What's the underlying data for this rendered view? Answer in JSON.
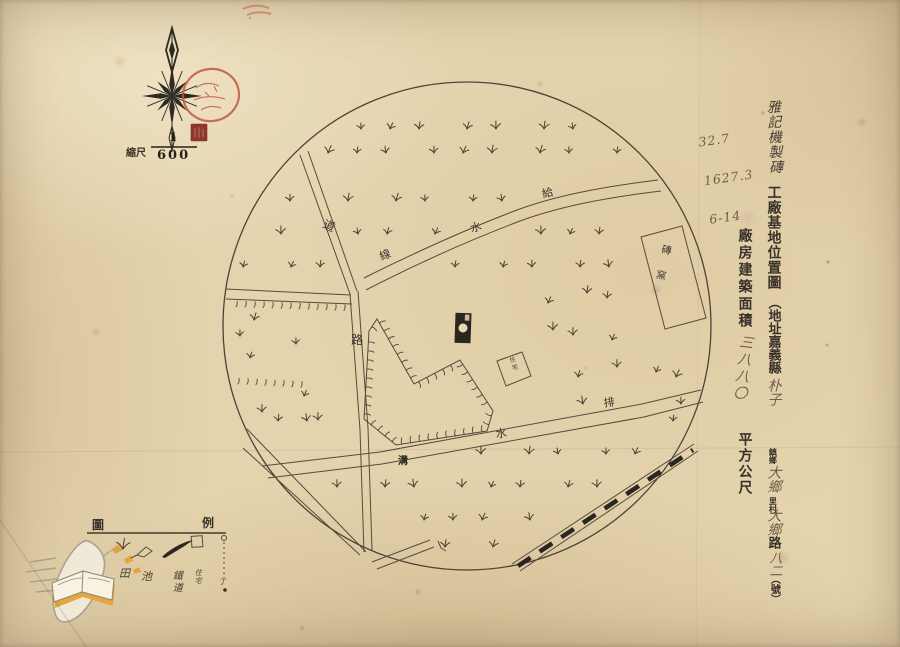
{
  "scale": {
    "label": "縮尺",
    "numerator": "1",
    "denominator": "600"
  },
  "annotations": {
    "note1": "32.7",
    "note2": "1627.3",
    "note3": "6-14"
  },
  "title_block": {
    "company_handwritten": "雅記機製磚",
    "title_typed": "工廠基地位置圖",
    "address_prefix": "（地址嘉義縣",
    "address_town_hand": "朴子",
    "address_unit_town": "鎮鄉",
    "address_li_hand": "大鄉",
    "address_unit_li": "里村",
    "address_road_hand": "大鄉",
    "address_road_typed": "路",
    "address_no_hand": "八二",
    "address_no_typed": "（號）",
    "area_label": "廠房建築面積",
    "area_value_hand": "三八八〇",
    "area_unit": "平方公尺"
  },
  "map_labels": {
    "road_upper": "道",
    "road_main": "路",
    "waterline": [
      "給",
      "水",
      "線"
    ],
    "drain": [
      "排",
      "水",
      "溝"
    ],
    "kiln": "磚窯",
    "house": "住宅"
  },
  "legend": {
    "title": [
      "圖",
      "例"
    ],
    "items": [
      {
        "symbol": "paddy-tuft",
        "label": "田"
      },
      {
        "symbol": "pond",
        "label": "池"
      },
      {
        "symbol": "railway",
        "label": "鐵道"
      },
      {
        "symbol": "house-square",
        "label": "住宅"
      },
      {
        "symbol": "boundary-pole",
        "label": "丁"
      }
    ]
  },
  "colors": {
    "paper": "#e4d3ad",
    "ink": "#3c342a",
    "map_line": "#564b3c",
    "pencil": "#6e5f4a",
    "stamp_red": "#bb4a33",
    "seal_red": "#8c392b",
    "watermark_orange": "#e6a53c",
    "watermark_gray": "#a89f8e"
  }
}
